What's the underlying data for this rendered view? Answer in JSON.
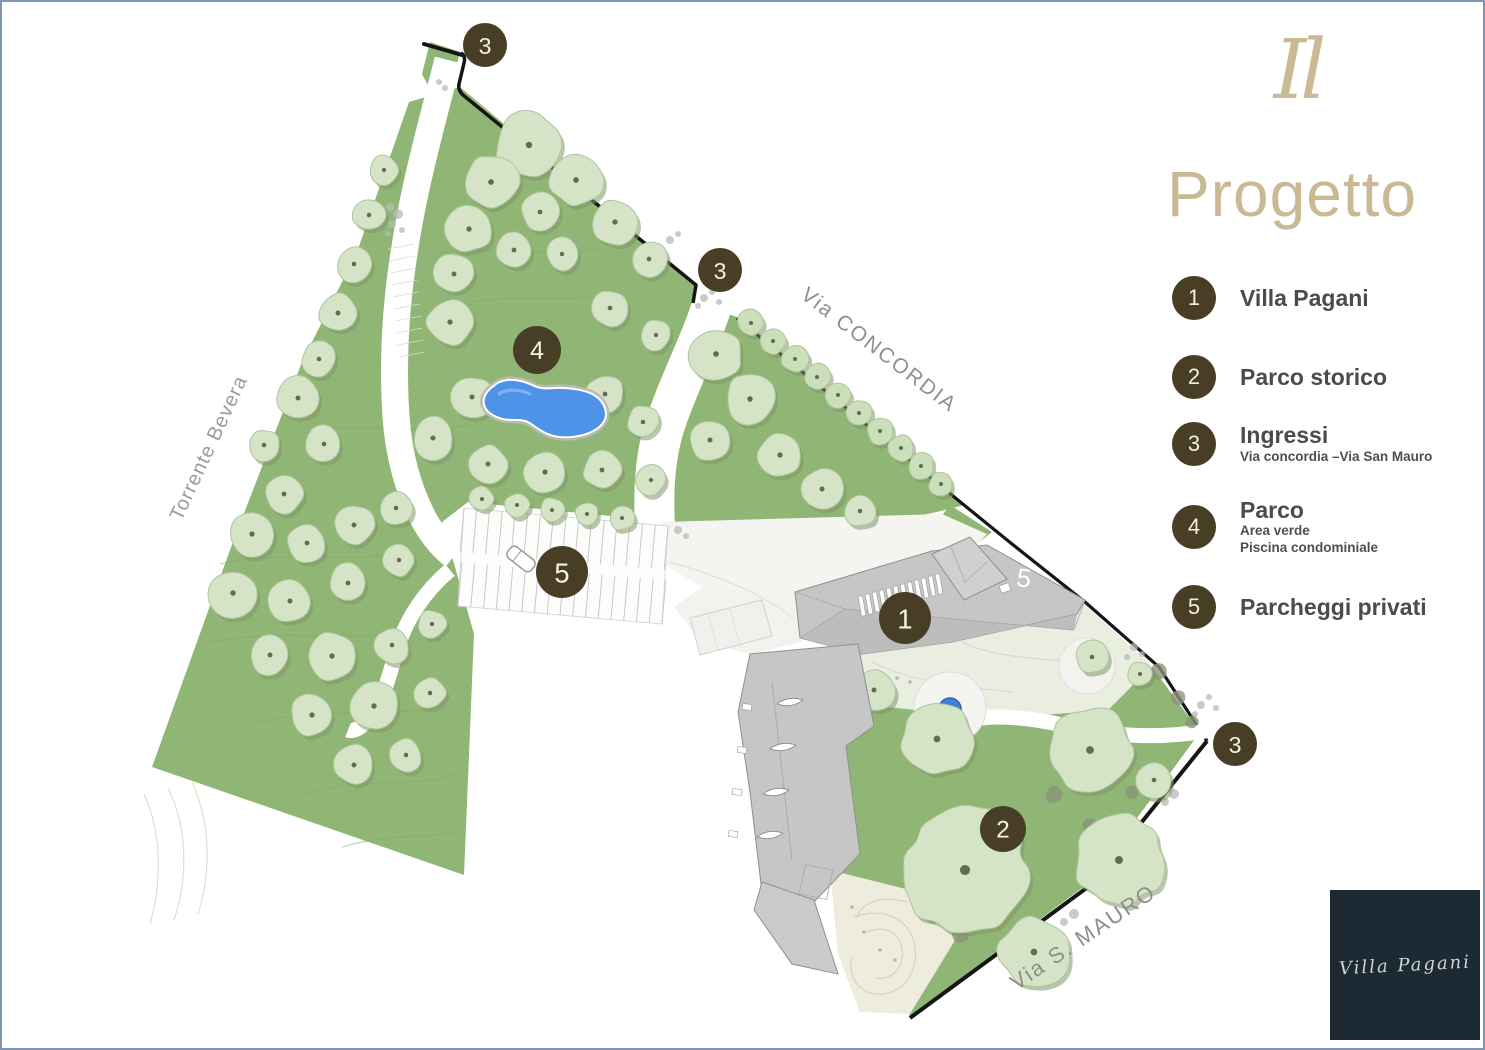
{
  "slide": {
    "border_color": "#8095b3",
    "background": "#ffffff"
  },
  "header": {
    "logo_mark": "Il",
    "title": "Progetto",
    "accent_color": "#c9b994"
  },
  "legend": {
    "badge_color": "#483e25",
    "items": [
      {
        "num": "1",
        "title": "Villa Pagani",
        "sub1": "",
        "sub2": ""
      },
      {
        "num": "2",
        "title": "Parco storico",
        "sub1": "",
        "sub2": ""
      },
      {
        "num": "3",
        "title": "Ingressi",
        "sub1": "Via concordia –Via San Mauro",
        "sub2": ""
      },
      {
        "num": "4",
        "title": "Parco",
        "sub1": "Area verde",
        "sub2": "Piscina condominiale"
      },
      {
        "num": "5",
        "title": "Parcheggi privati",
        "sub1": "",
        "sub2": ""
      }
    ]
  },
  "footer_logo": {
    "text": "Villa Pagani",
    "bg": "#1e2a33",
    "fg": "#ccd5d9"
  },
  "map": {
    "marker_color": "#483e25",
    "marker_text_color": "#f6f1e0",
    "park_green": "#8fb674",
    "pale_green": "#e9eee1",
    "tree_fill": "#d5e4c6",
    "tree_shadow": "#7f9868",
    "roof_label": "5",
    "street_labels": [
      {
        "text": "Via CONCORDIA",
        "x": 877,
        "y": 348,
        "rotate": 37.5,
        "size": 21,
        "ls": 2,
        "color": "#8f8f8f"
      },
      {
        "text": "Via S. MAURO",
        "x": 1081,
        "y": 935,
        "rotate": -34,
        "size": 22,
        "ls": 2,
        "color": "#8d8d8d"
      },
      {
        "text": "Torrente Bevera",
        "x": 207,
        "y": 446,
        "rotate": -65,
        "size": 20,
        "ls": 1,
        "color": "#9b9b9b"
      }
    ],
    "markers": [
      {
        "n": "3",
        "x": 483,
        "y": 43,
        "r": 22
      },
      {
        "n": "3",
        "x": 718,
        "y": 268,
        "r": 22
      },
      {
        "n": "4",
        "x": 535,
        "y": 348,
        "r": 24
      },
      {
        "n": "5",
        "x": 560,
        "y": 570,
        "r": 26
      },
      {
        "n": "1",
        "x": 903,
        "y": 616,
        "r": 26
      },
      {
        "n": "2",
        "x": 1001,
        "y": 827,
        "r": 23
      },
      {
        "n": "3",
        "x": 1233,
        "y": 742,
        "r": 22
      }
    ],
    "pool": {
      "x": 545,
      "y": 405,
      "color": "#4f93e8"
    },
    "fountain": {
      "x": 948,
      "y": 707,
      "color": "#3f7fd6"
    },
    "trees_park": [
      [
        527,
        143,
        34
      ],
      [
        574,
        178,
        27
      ],
      [
        613,
        220,
        24
      ],
      [
        647,
        257,
        19
      ],
      [
        489,
        180,
        28
      ],
      [
        538,
        210,
        20
      ],
      [
        467,
        227,
        24
      ],
      [
        512,
        248,
        20
      ],
      [
        560,
        252,
        17
      ],
      [
        452,
        272,
        21
      ],
      [
        448,
        320,
        24
      ],
      [
        608,
        306,
        19
      ],
      [
        654,
        333,
        16
      ],
      [
        470,
        395,
        22
      ],
      [
        431,
        436,
        22
      ],
      [
        603,
        392,
        20
      ],
      [
        641,
        420,
        17
      ],
      [
        486,
        462,
        20
      ],
      [
        543,
        470,
        23
      ],
      [
        600,
        468,
        20
      ],
      [
        649,
        478,
        16
      ],
      [
        480,
        497,
        13
      ],
      [
        515,
        503,
        13
      ],
      [
        550,
        508,
        13
      ],
      [
        585,
        512,
        13
      ],
      [
        620,
        516,
        13
      ],
      [
        714,
        352,
        27
      ],
      [
        748,
        397,
        26
      ],
      [
        708,
        438,
        22
      ],
      [
        778,
        453,
        24
      ],
      [
        820,
        487,
        22
      ],
      [
        858,
        509,
        17
      ],
      [
        382,
        168,
        16
      ],
      [
        367,
        213,
        17
      ],
      [
        352,
        262,
        19
      ],
      [
        336,
        311,
        21
      ],
      [
        317,
        357,
        18
      ],
      [
        296,
        396,
        22
      ],
      [
        322,
        442,
        19
      ],
      [
        262,
        443,
        17
      ],
      [
        282,
        492,
        20
      ],
      [
        250,
        532,
        23
      ],
      [
        305,
        541,
        20
      ],
      [
        352,
        523,
        21
      ],
      [
        394,
        506,
        17
      ],
      [
        231,
        591,
        25
      ],
      [
        288,
        599,
        22
      ],
      [
        346,
        581,
        20
      ],
      [
        397,
        558,
        17
      ],
      [
        268,
        653,
        21
      ],
      [
        330,
        654,
        25
      ],
      [
        390,
        643,
        19
      ],
      [
        430,
        622,
        15
      ],
      [
        310,
        713,
        23
      ],
      [
        372,
        704,
        25
      ],
      [
        428,
        691,
        17
      ],
      [
        352,
        763,
        21
      ],
      [
        404,
        753,
        17
      ]
    ],
    "trees_hedge": [
      [
        749,
        321,
        14
      ],
      [
        771,
        339,
        14
      ],
      [
        793,
        357,
        14
      ],
      [
        815,
        375,
        14
      ],
      [
        836,
        393,
        14
      ],
      [
        857,
        411,
        14
      ],
      [
        878,
        429,
        14
      ],
      [
        899,
        446,
        14
      ],
      [
        919,
        464,
        14
      ],
      [
        939,
        482,
        13
      ]
    ],
    "trees_parco": [
      [
        935,
        737,
        36
      ],
      [
        1088,
        748,
        44
      ],
      [
        963,
        868,
        64
      ],
      [
        1117,
        858,
        46
      ],
      [
        1032,
        950,
        36
      ],
      [
        872,
        688,
        22
      ],
      [
        1152,
        778,
        18
      ],
      [
        1090,
        655,
        18
      ],
      [
        1138,
        672,
        13
      ]
    ]
  }
}
